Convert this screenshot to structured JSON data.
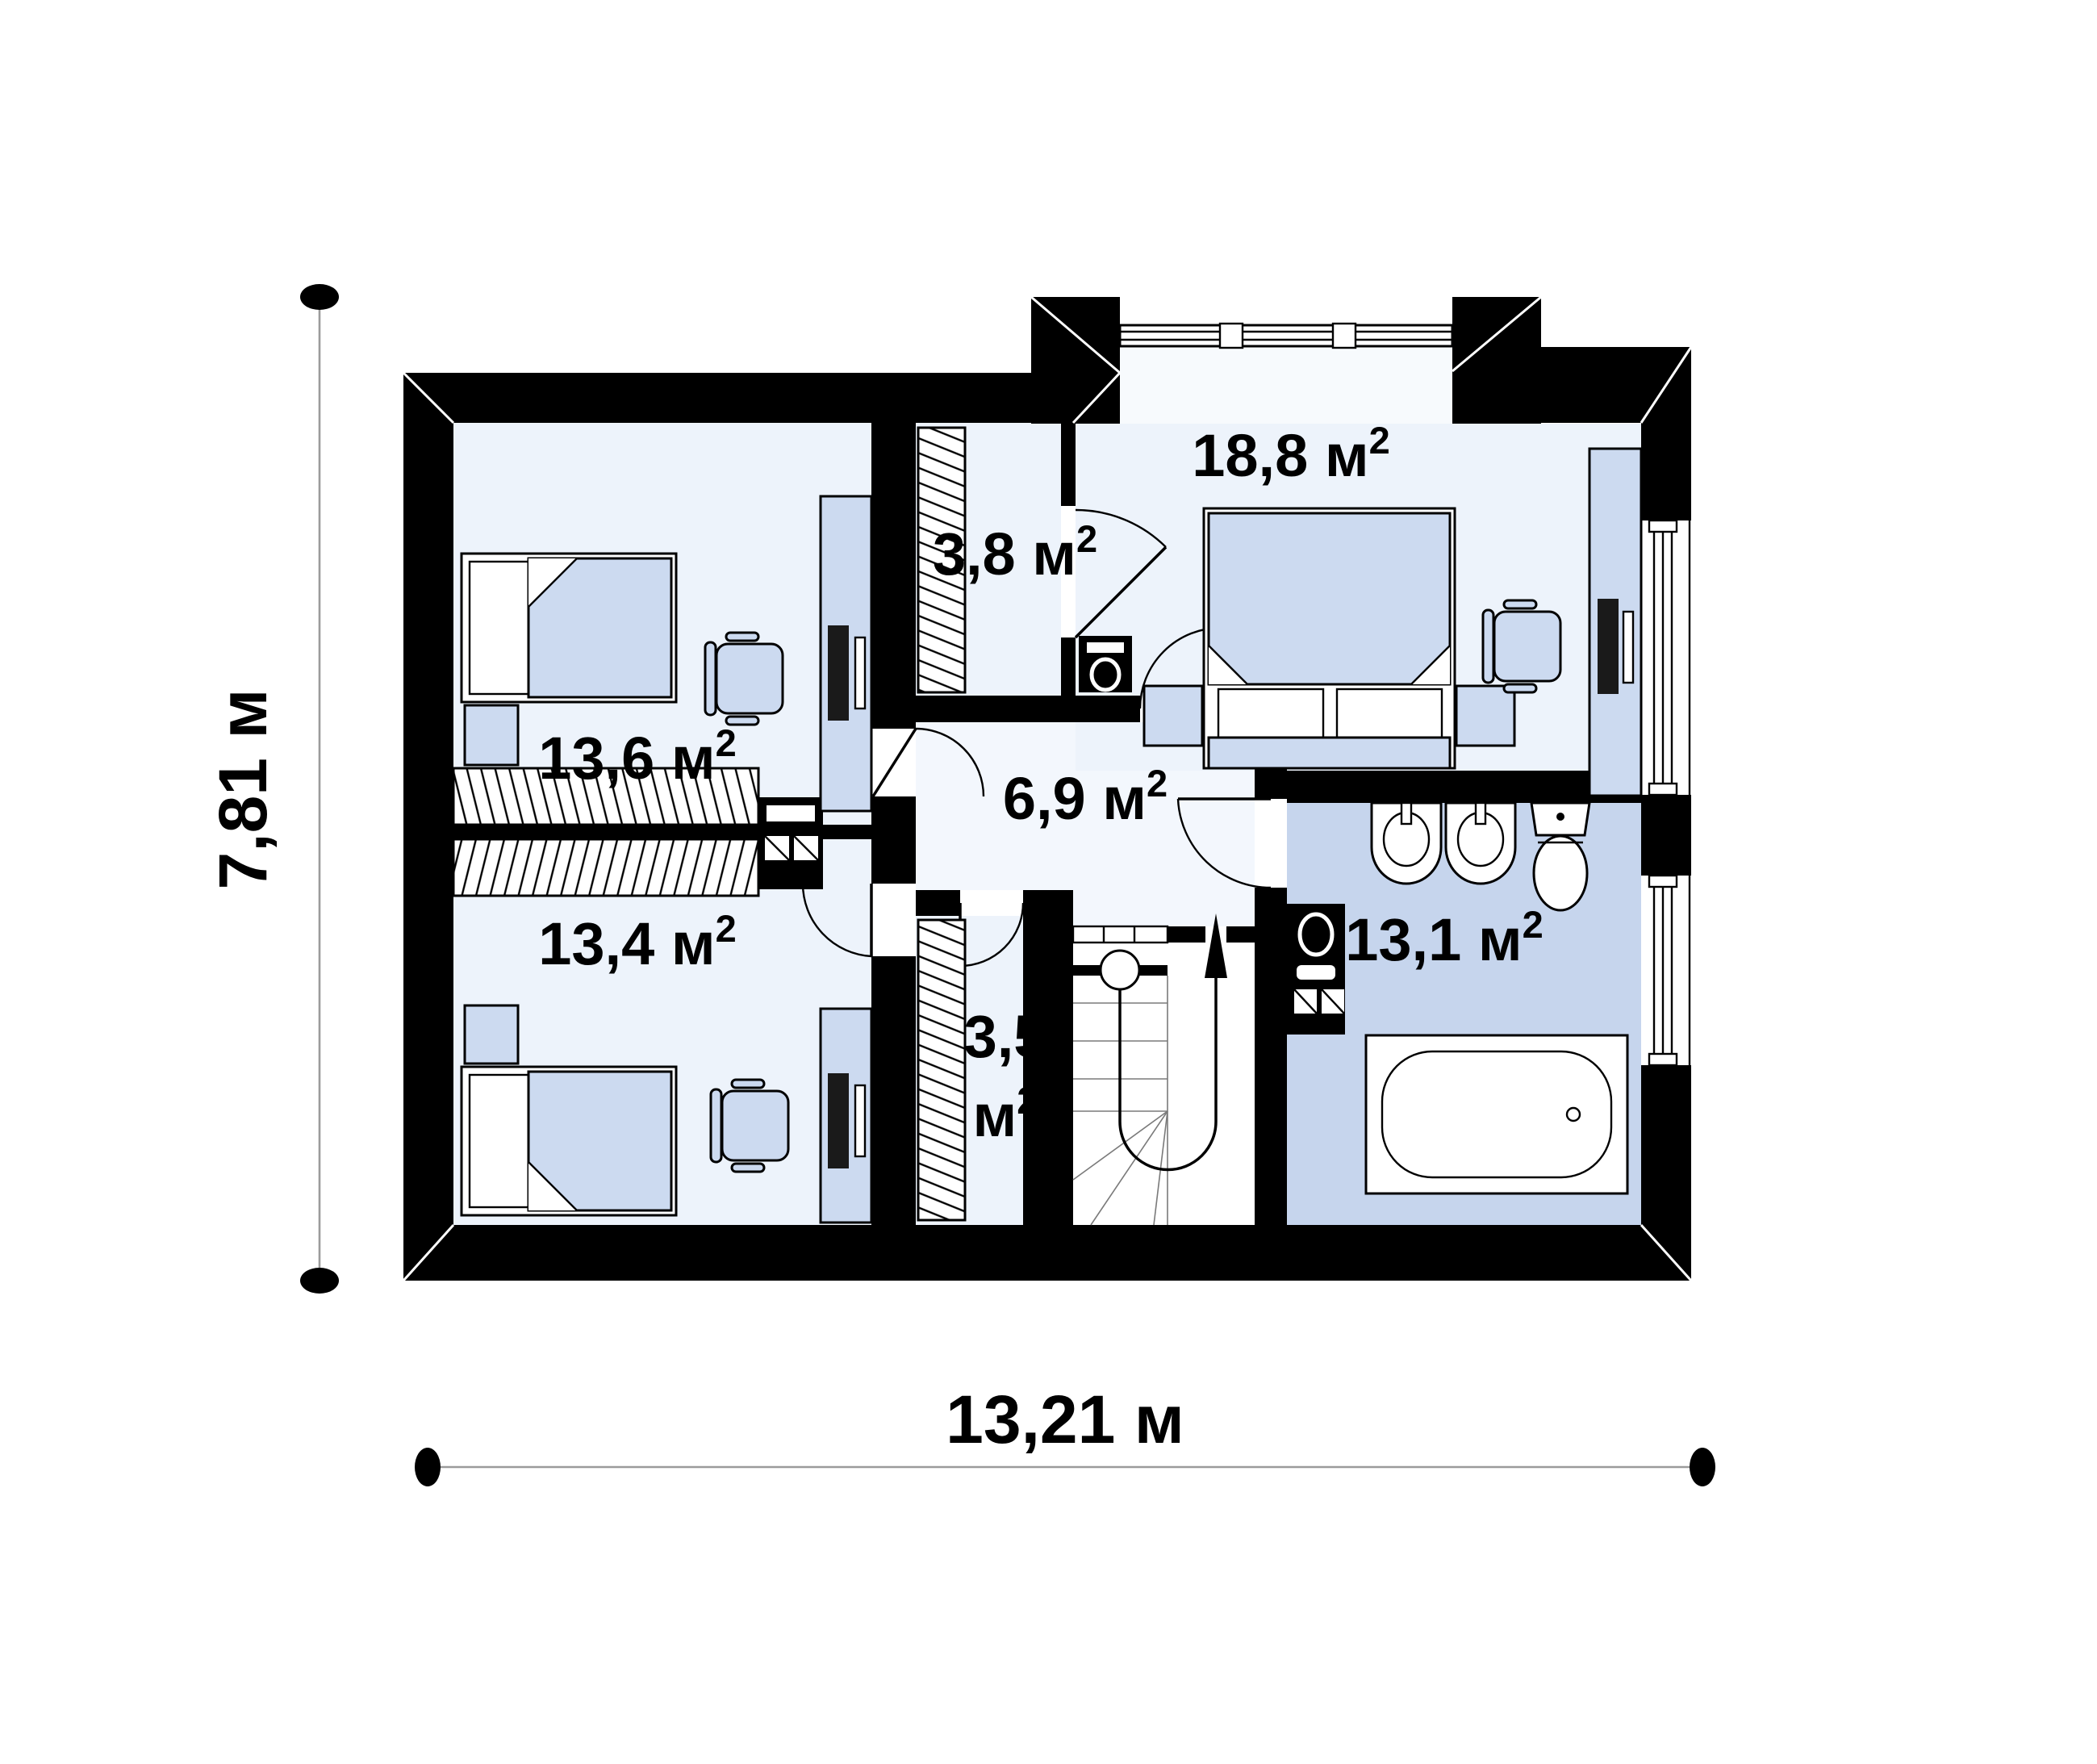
{
  "plan": {
    "title": "apartment-floor-plan",
    "rooms": [
      {
        "id": "bedroom-top-left",
        "area": "13,6"
      },
      {
        "id": "closet-top",
        "area": "3,8"
      },
      {
        "id": "bedroom-top-right",
        "area": "18,8"
      },
      {
        "id": "hall",
        "area": "6,9"
      },
      {
        "id": "bedroom-bottom-left",
        "area": "13,4"
      },
      {
        "id": "closet-bottom",
        "area": "3,5"
      },
      {
        "id": "bathroom",
        "area": "13,1"
      }
    ],
    "unit": " м",
    "unit_solo": "м",
    "sup": "2",
    "dimensions": {
      "height": "7,81 м",
      "width": "13,21 м"
    },
    "fixtures": [
      "single-bed",
      "single-bed",
      "double-bed",
      "desk-with-computer",
      "desk-with-computer",
      "desk-with-computer",
      "office-chair",
      "office-chair",
      "office-chair",
      "wardrobe-hatched",
      "wardrobe-hatched",
      "wardrobe-hatched",
      "wardrobe-hatched",
      "washing-machine",
      "appliance-stack",
      "ventilation-duct",
      "washbasin",
      "washbasin",
      "toilet",
      "bathtub",
      "u-shaped-staircase",
      "stair-railing",
      "dormer-window",
      "window",
      "window"
    ]
  },
  "colors": {
    "background": "#ffffff",
    "wall": "#000000",
    "room_fill": "#edf3fb",
    "hall_fill": "#f3f7fd",
    "bath_fill": "#c6d5ed",
    "dormer_fill": "#f7fafd",
    "furniture_fill": "#ccdaf0",
    "dimension_line": "#9b9b9b"
  }
}
